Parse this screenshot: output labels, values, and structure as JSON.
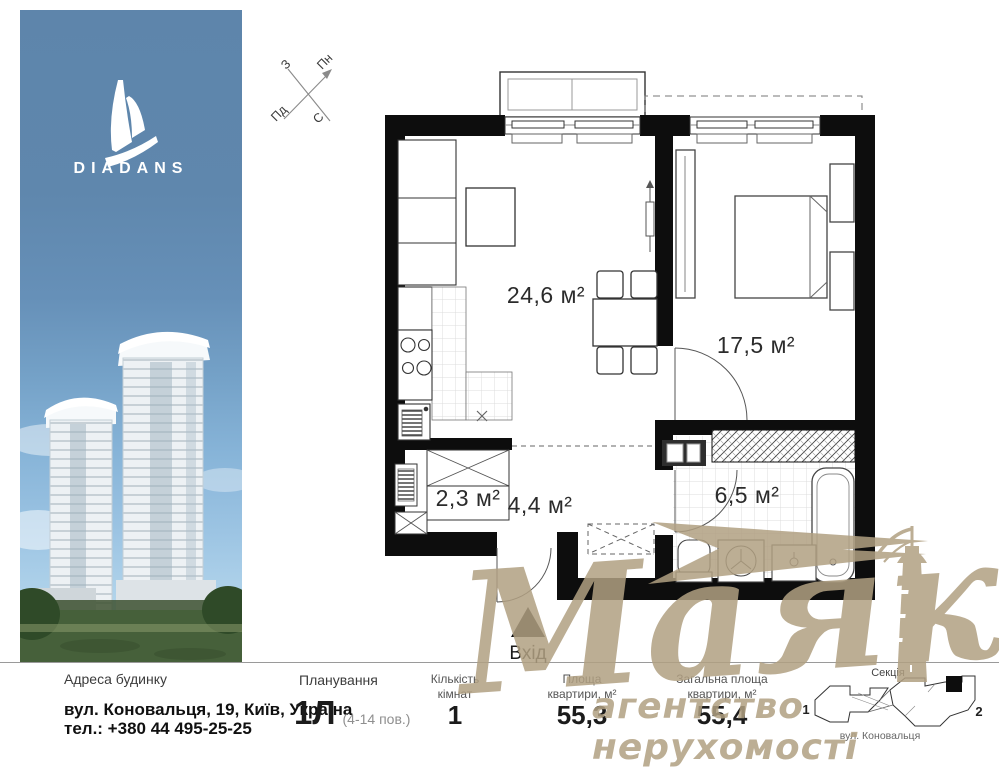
{
  "sidebar": {
    "brand": "DIADANS"
  },
  "compass": {
    "n": "Пн",
    "e": "С",
    "s": "Пд",
    "w": "З"
  },
  "plan": {
    "living": "24,6 м²",
    "bedroom": "17,5 м²",
    "closet": "2,3 м²",
    "hall": "4,4 м²",
    "bath": "6,5 м²",
    "entrance": "Вхід"
  },
  "watermark": {
    "title": "Маяк",
    "subtitle": "агентство нерухомості",
    "color": "#b1a082"
  },
  "footer": {
    "address_label": "Адреса будинку",
    "address_line1": "вул. Коновальця, 19, Київ, Україна",
    "address_line2": "тел.: +380 44 495-25-25",
    "plan_label": "Планування",
    "plan_value": "1Л",
    "plan_note": "(4-14 пов.)",
    "rooms_label1": "Кількість",
    "rooms_label2": "кімнат",
    "rooms_value": "1",
    "area_label1": "Площа",
    "area_label2": "квартири, м²",
    "area_value": "55,3",
    "total_label1": "Загальна площа",
    "total_label2": "квартири, м²",
    "total_value": "55,4",
    "section_label": "Секція",
    "section_left": "1",
    "section_right": "2",
    "street_label": "вул. Коновальця"
  }
}
